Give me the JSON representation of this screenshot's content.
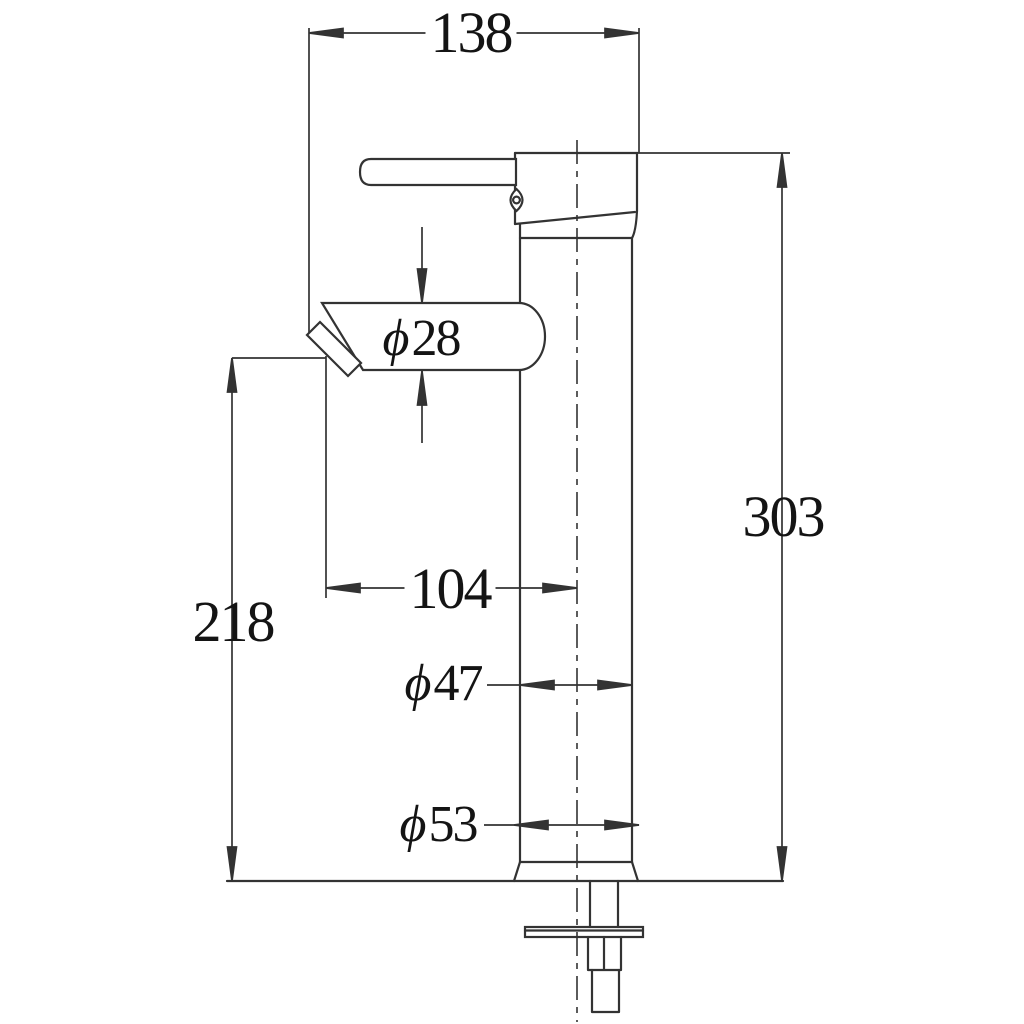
{
  "drawing": {
    "type": "technical-drawing-faucet-side-view",
    "background_color": "#ffffff",
    "line_color": "#333333",
    "text_color": "#141414",
    "dimensions": {
      "overall_width": {
        "label": "138"
      },
      "overall_height": {
        "label": "303"
      },
      "outlet_height": {
        "label": "218"
      },
      "spout_reach": {
        "label": "104"
      },
      "spout_diameter": {
        "symbol": "ϕ",
        "value": "28"
      },
      "body_diameter": {
        "symbol": "ϕ",
        "value": "47"
      },
      "base_diameter": {
        "symbol": "ϕ",
        "value": "53"
      }
    }
  }
}
